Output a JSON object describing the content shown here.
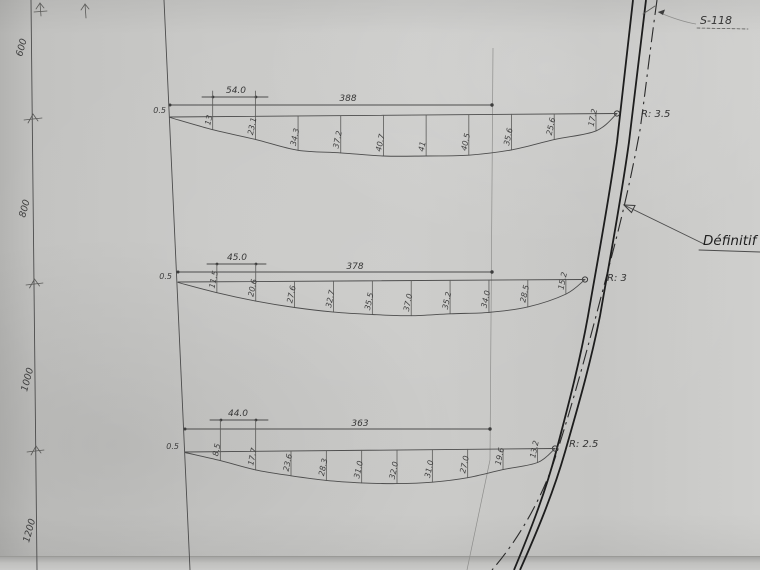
{
  "sheet": {
    "reference": "S-118",
    "status_note": "Définitif",
    "ruler_labels": [
      "600",
      "800",
      "1000",
      "1200"
    ],
    "sections": [
      {
        "span": "388",
        "first_spacing": "54.0",
        "start_offset": "0.5",
        "corner_radius": "R: 3.5",
        "offsets": [
          "13",
          "23.1",
          "34.3",
          "37.2",
          "40.7",
          "41",
          "40.5",
          "35.6",
          "25.6",
          "17.2"
        ]
      },
      {
        "span": "378",
        "first_spacing": "45.0",
        "start_offset": "0.5",
        "corner_radius": "R: 3",
        "offsets": [
          "11.5",
          "20.6",
          "27.6",
          "32.7",
          "35.5",
          "37.0",
          "35.2",
          "34.0",
          "28.5",
          "15.2"
        ]
      },
      {
        "span": "363",
        "first_spacing": "44.0",
        "start_offset": "0.5",
        "corner_radius": "R: 2.5",
        "offsets": [
          "8.5",
          "17.7",
          "23.6",
          "28.3",
          "31.0",
          "32.0",
          "31.0",
          "27.0",
          "19.6",
          "13.2"
        ]
      }
    ]
  }
}
